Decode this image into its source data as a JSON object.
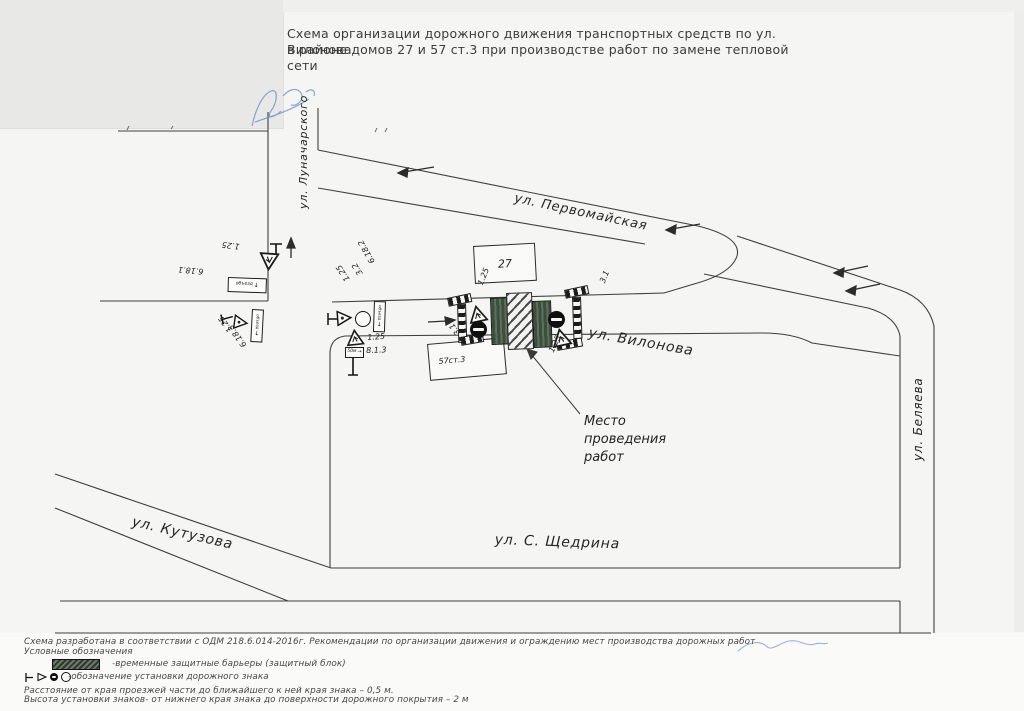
{
  "title": {
    "line1": "Схема организации дорожного движения транспортных средств по ул. Вилонова",
    "line2": "в районе домов 27 и 57 ст.3 при производстве работ по замене тепловой сети"
  },
  "streets": {
    "pervomayskaya": "ул. Первомайская",
    "vilonova": "ул. Вилонова",
    "belyaeva": "ул. Беляева",
    "lunacharskogo": "ул. Луначарского",
    "kutuzova": "ул. Кутузова",
    "schedrina": "ул. С. Щедрина"
  },
  "buildings": {
    "house27": "27",
    "house57_st3": "57ст.3"
  },
  "work_site_note": {
    "line1": "Место",
    "line2": "проведения",
    "line3": "работ"
  },
  "signs": {
    "road_works": "1.25",
    "no_entry": "3.1",
    "movement_prohibited": "3.2",
    "distance_plate": "8.1.3",
    "detour_1": "6.18.1",
    "detour_2": "6.18.2",
    "detour_3": "6.18.3",
    "detour_plate_text": "объезд",
    "distance_plate_text": "50м",
    "arrow_down": "↓",
    "arrow_right": "→"
  },
  "legend": {
    "basis": "Схема разработана в соответствии с ОДМ 218.6.014-2016г. Рекомендации по организации движения и ограждению мест производства дорожных работ",
    "heading": "Условные обозначения",
    "barriers_item": "-временные защитные барьеры (защитный блок)",
    "sign_post_item": "-обозначение установки дорожного знака",
    "note_distance": "Расстояние от края проезжей части до ближайшего к ней края знака – 0,5 м.",
    "note_height": "Высота установки знаков- от нижнего края знака до поверхности дорожного покрытия – 2 м"
  }
}
